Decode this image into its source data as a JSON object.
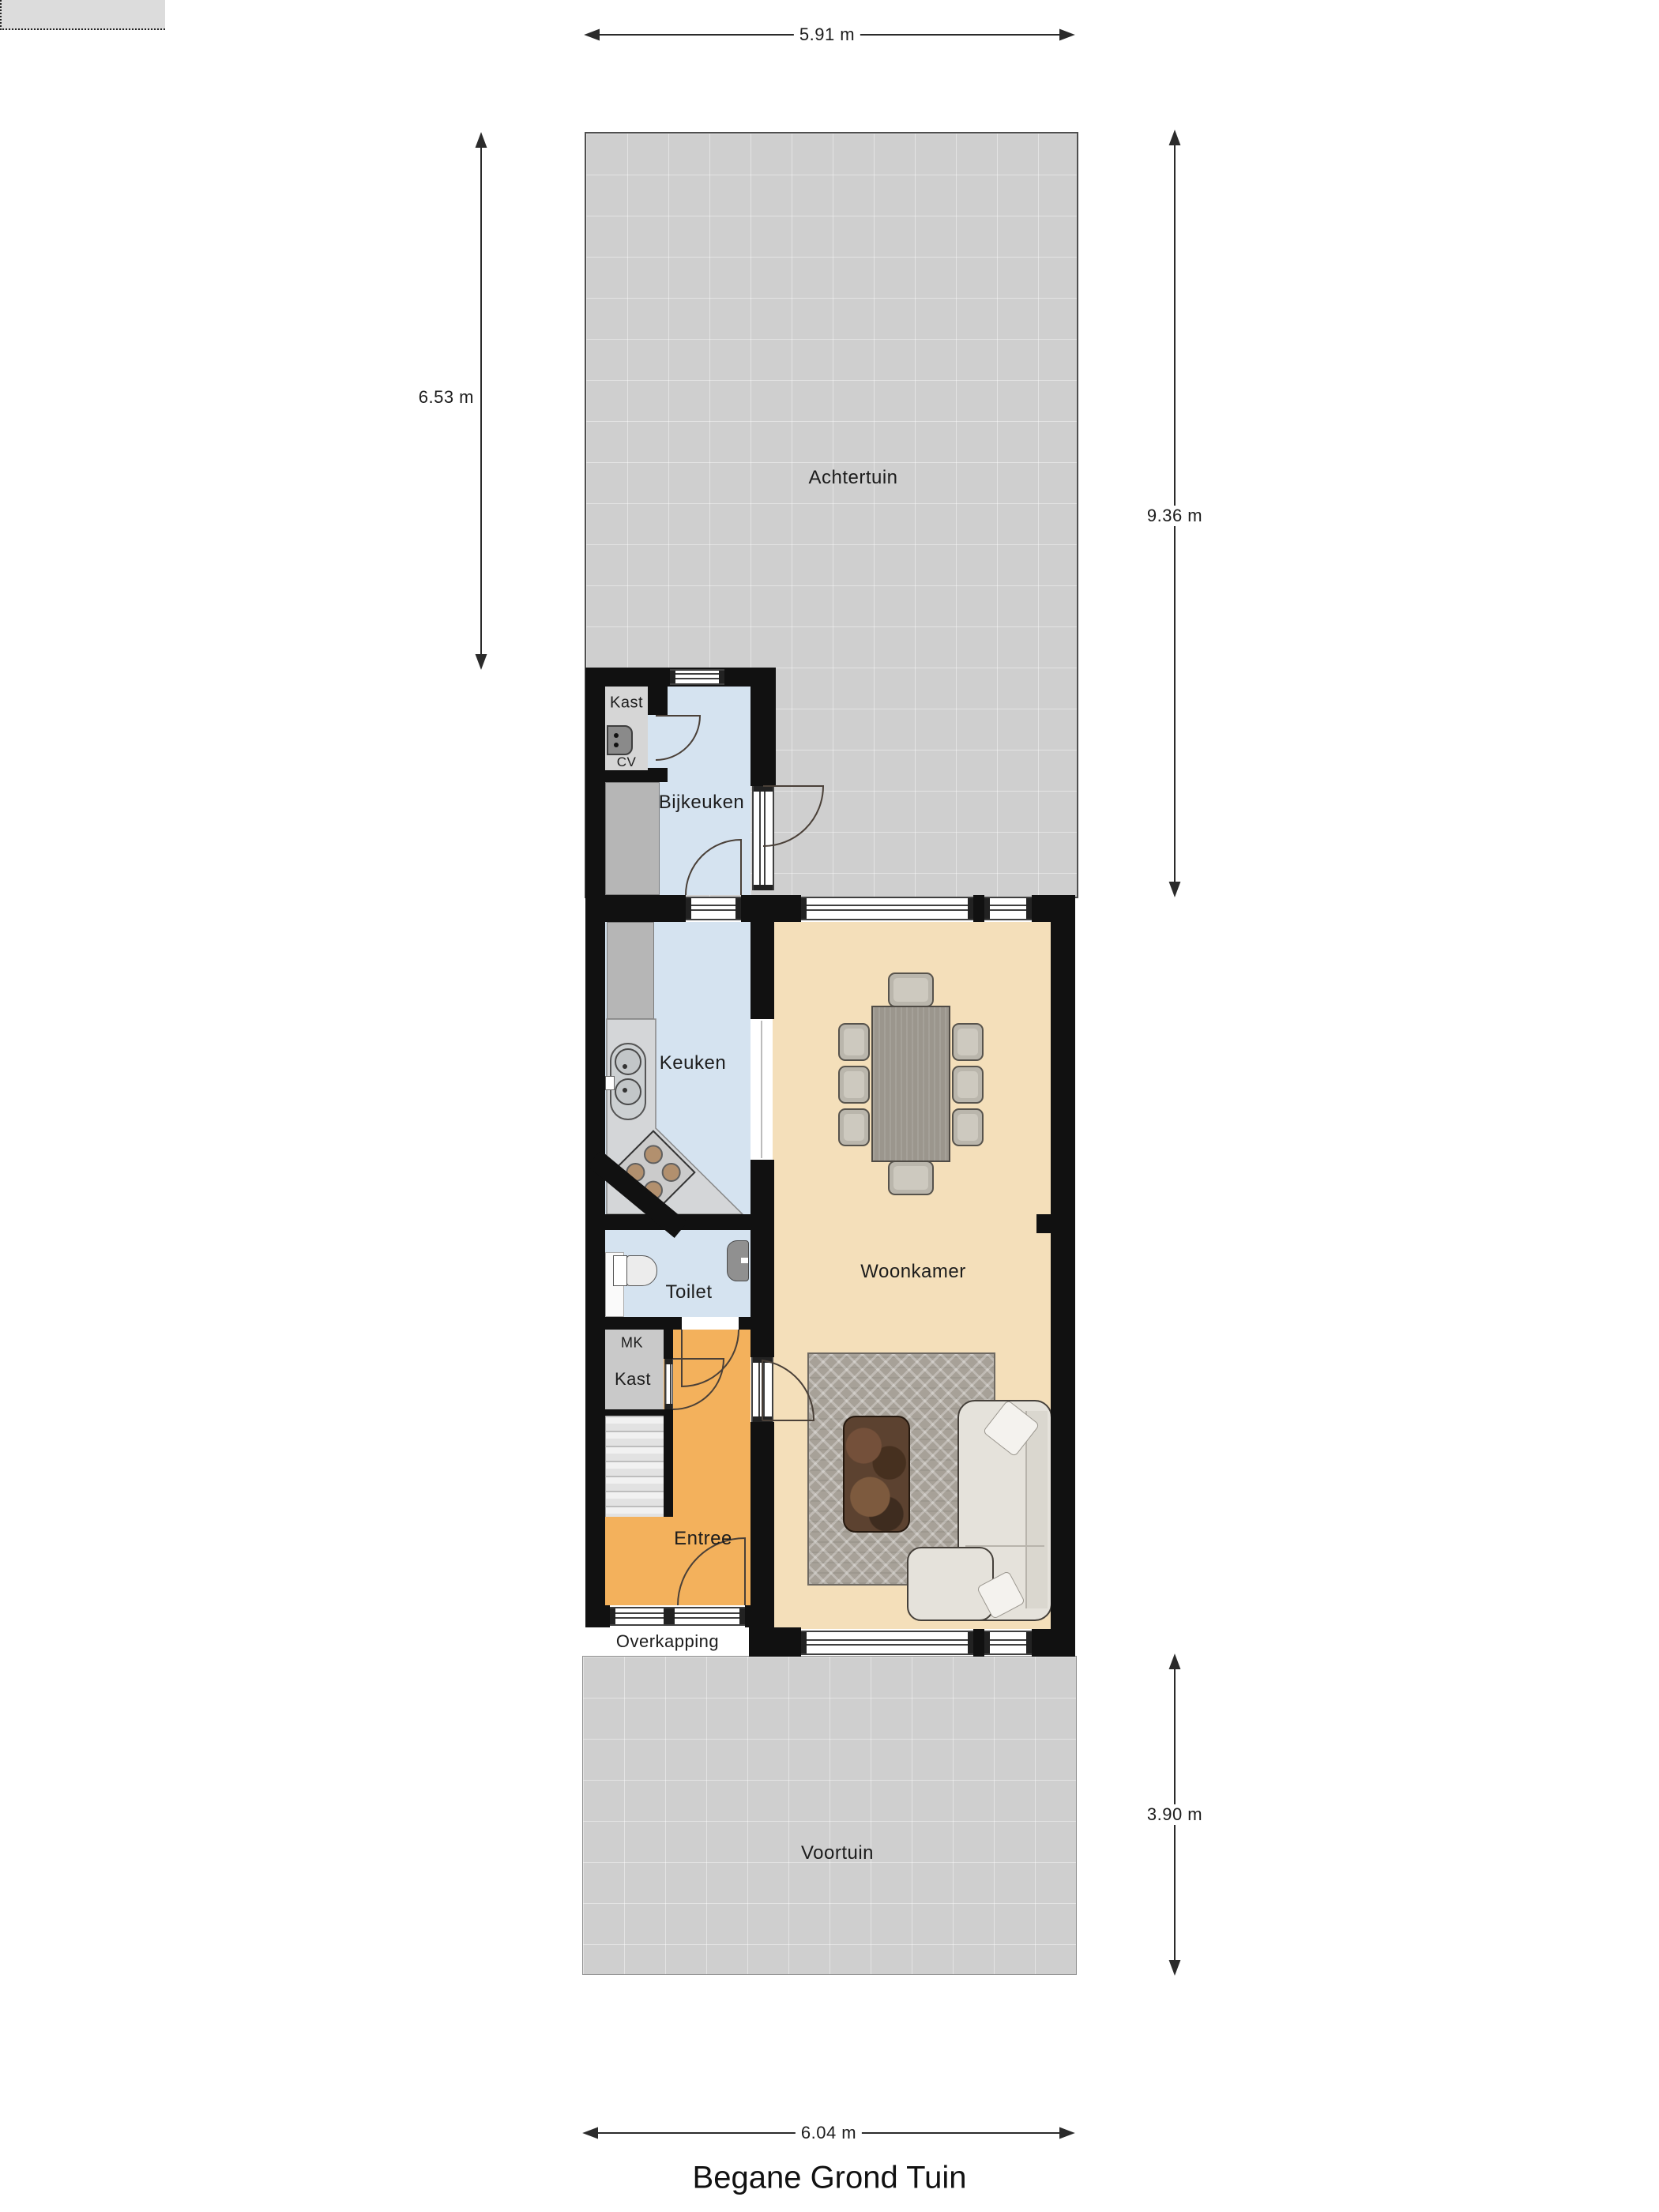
{
  "title": "Begane Grond Tuin",
  "rooms": {
    "achtertuin": {
      "label": "Achtertuin"
    },
    "voortuin": {
      "label": "Voortuin"
    },
    "woonkamer": {
      "label": "Woonkamer"
    },
    "keuken": {
      "label": "Keuken"
    },
    "bijkeuken": {
      "label": "Bijkeuken"
    },
    "toilet": {
      "label": "Toilet"
    },
    "entree": {
      "label": "Entree"
    },
    "overkapping": {
      "label": "Overkapping"
    },
    "kast_cv": {
      "label": "Kast"
    },
    "cv": {
      "label": "CV"
    },
    "mk": {
      "label": "MK"
    },
    "kast_hal": {
      "label": "Kast"
    }
  },
  "dimensions": {
    "top_width": "5.91 m",
    "garden_depth_left": "6.53 m",
    "right_depth": "9.36 m",
    "front_depth": "3.90 m",
    "bottom_width": "6.04 m"
  },
  "colors": {
    "wall": "#111111",
    "floor-blue": "#d5e3f0",
    "floor-beige": "#f4dfba",
    "floor-orange": "#f3b15c",
    "garden": "#cfcfcf",
    "overkapping": "#dcdcdc",
    "counter-gray": "#b6b6b6",
    "counter-light": "#d4d6d8",
    "kastroom": "#d6d6d6",
    "mkroom": "#c9c9c9",
    "rug": "#a7a198",
    "sofa": "#e5e2db",
    "table": "#9b968d",
    "chair": "#bab6ac",
    "coffee": "#5c4230"
  }
}
